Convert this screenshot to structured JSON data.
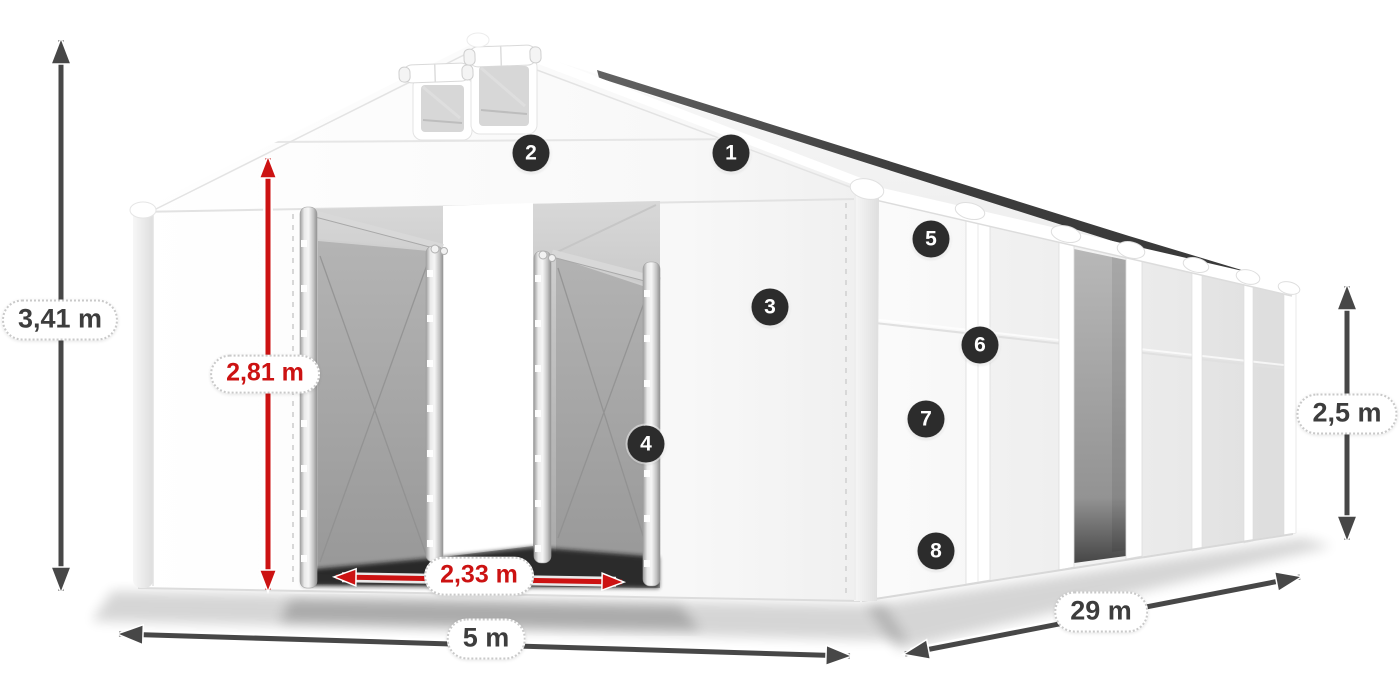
{
  "diagram": {
    "subject": "white-storage-tent-with-open-entrances",
    "background": "#ffffff",
    "dimension_labels": {
      "total_height": "3,41 m",
      "entrance_height": "2,81 m",
      "entrance_width": "2,33 m",
      "width": "5 m",
      "length": "29 m",
      "side_height": "2,5 m"
    },
    "feature_badges": [
      {
        "number": "1",
        "x": 731,
        "y": 153
      },
      {
        "number": "2",
        "x": 531,
        "y": 153
      },
      {
        "number": "3",
        "x": 770,
        "y": 307
      },
      {
        "number": "4",
        "x": 646,
        "y": 444
      },
      {
        "number": "5",
        "x": 931,
        "y": 239
      },
      {
        "number": "6",
        "x": 980,
        "y": 345
      },
      {
        "number": "7",
        "x": 926,
        "y": 419
      },
      {
        "number": "8",
        "x": 936,
        "y": 551
      }
    ],
    "colors": {
      "dimension_dark": "#474747",
      "dimension_red": "#cc1212",
      "badge_background": "#2c2c2c",
      "badge_number": "#ffffff",
      "label_background": "#ffffff",
      "label_border": "#c9c9c9",
      "label_text": "#3d3d3d",
      "tent_surface": "#f7f7f7",
      "interior_panel": "#a9a9a9",
      "roof_edge_shadow": "#383838"
    }
  }
}
